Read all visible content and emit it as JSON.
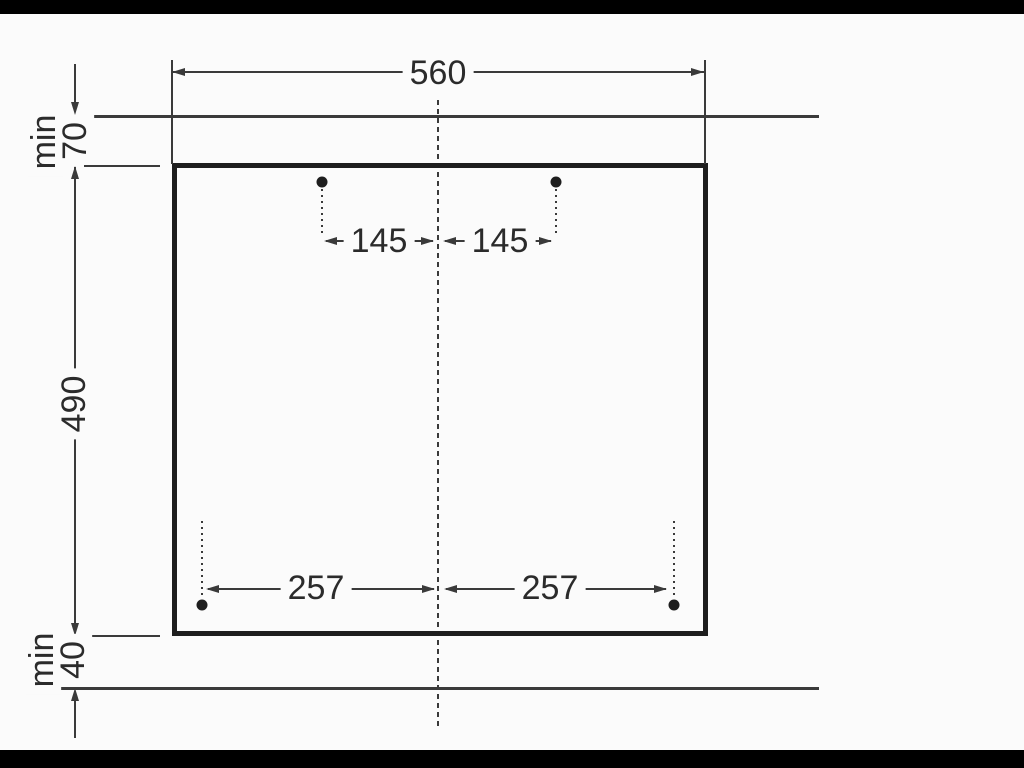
{
  "colors": {
    "bg": "#fbfbfb",
    "ink": "#3a3a3a",
    "heavy": "#1e1e1e",
    "text": "#2b2b2b",
    "bar": "#000000"
  },
  "diagram": {
    "cutout_width": "560",
    "cutout_height": "490",
    "top_clearance": {
      "min": "min",
      "value": "70"
    },
    "bottom_clearance": {
      "min": "min",
      "value": "40"
    },
    "top_fixing_offset_left": "145",
    "top_fixing_offset_right": "145",
    "bottom_fixing_offset_left": "257",
    "bottom_fixing_offset_right": "257"
  }
}
